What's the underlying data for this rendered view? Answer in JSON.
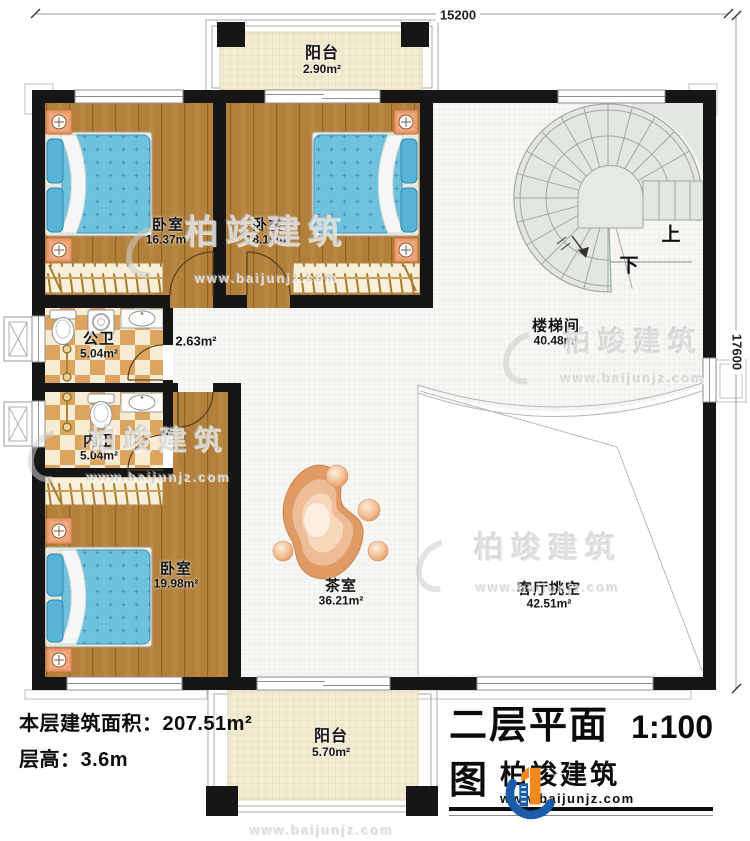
{
  "plan": {
    "dimensions": {
      "width": "15200",
      "height": "17600"
    },
    "stairs": {
      "up": "上",
      "down": "下"
    },
    "rooms": [
      {
        "name": "阳台",
        "area": "2.90m²"
      },
      {
        "name": "卧室",
        "area": "16.37m²"
      },
      {
        "name": "卧室",
        "area": "18.15m²"
      },
      {
        "name": "楼梯间",
        "area": "40.48m²"
      },
      {
        "name": "公卫",
        "area": "5.04m²"
      },
      {
        "name": "",
        "area": "2.63m²"
      },
      {
        "name": "内卫",
        "area": "5.04m²"
      },
      {
        "name": "卧室",
        "area": "19.98m²"
      },
      {
        "name": "茶室",
        "area": "36.21m²"
      },
      {
        "name": "客厅挑空",
        "area": "42.51m²"
      },
      {
        "name": "阳台",
        "area": "5.70m²"
      }
    ]
  },
  "footer": {
    "floor_area_label": "本层建筑面积：",
    "floor_area_value": "207.51m²",
    "floor_height_label": "层高：",
    "floor_height_value": "3.6m"
  },
  "title_block": {
    "title": "二层平面图",
    "scale": "1:100"
  },
  "logo": {
    "brand": "柏竣建筑",
    "url": "www.baijunjz.com"
  },
  "watermark": {
    "brand": "柏竣建筑",
    "url": "www.baijunjz.com"
  },
  "colors": {
    "accent_blue": "#1b5ca8",
    "accent_orange": "#f08a1e",
    "wall": "#161616"
  }
}
